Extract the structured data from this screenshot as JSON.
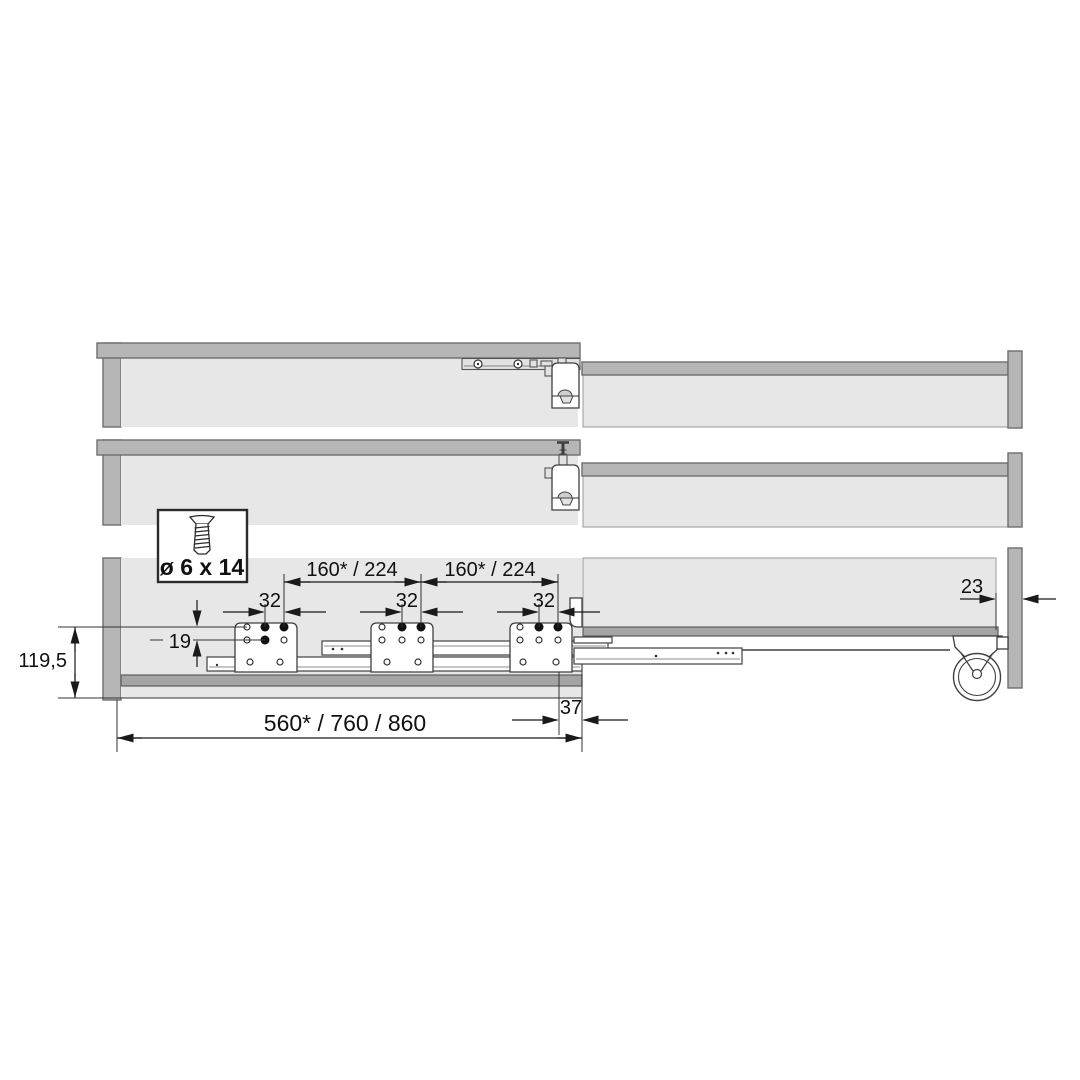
{
  "meta": {
    "drawing_type": "pull-out runner installation side-view diagram",
    "colors": {
      "panel_gray": "#b6b6b6",
      "interior_gray": "#e7e7e7",
      "shelf_gray": "#a4a4a4",
      "line_dark": "#1a1a1a",
      "background": "#ffffff"
    }
  },
  "labels": {
    "screw_spec": "ø 6 x 14",
    "dim_spacing_left": "160* / 224",
    "dim_spacing_right": "160* / 224",
    "dim_pitch_1": "32",
    "dim_pitch_2": "32",
    "dim_pitch_3": "32",
    "dim_height_offset": "19",
    "dim_total_height": "119,5",
    "dim_length_options": "560* / 760 / 860",
    "dim_front_offset": "37",
    "dim_rear_gap": "23"
  }
}
